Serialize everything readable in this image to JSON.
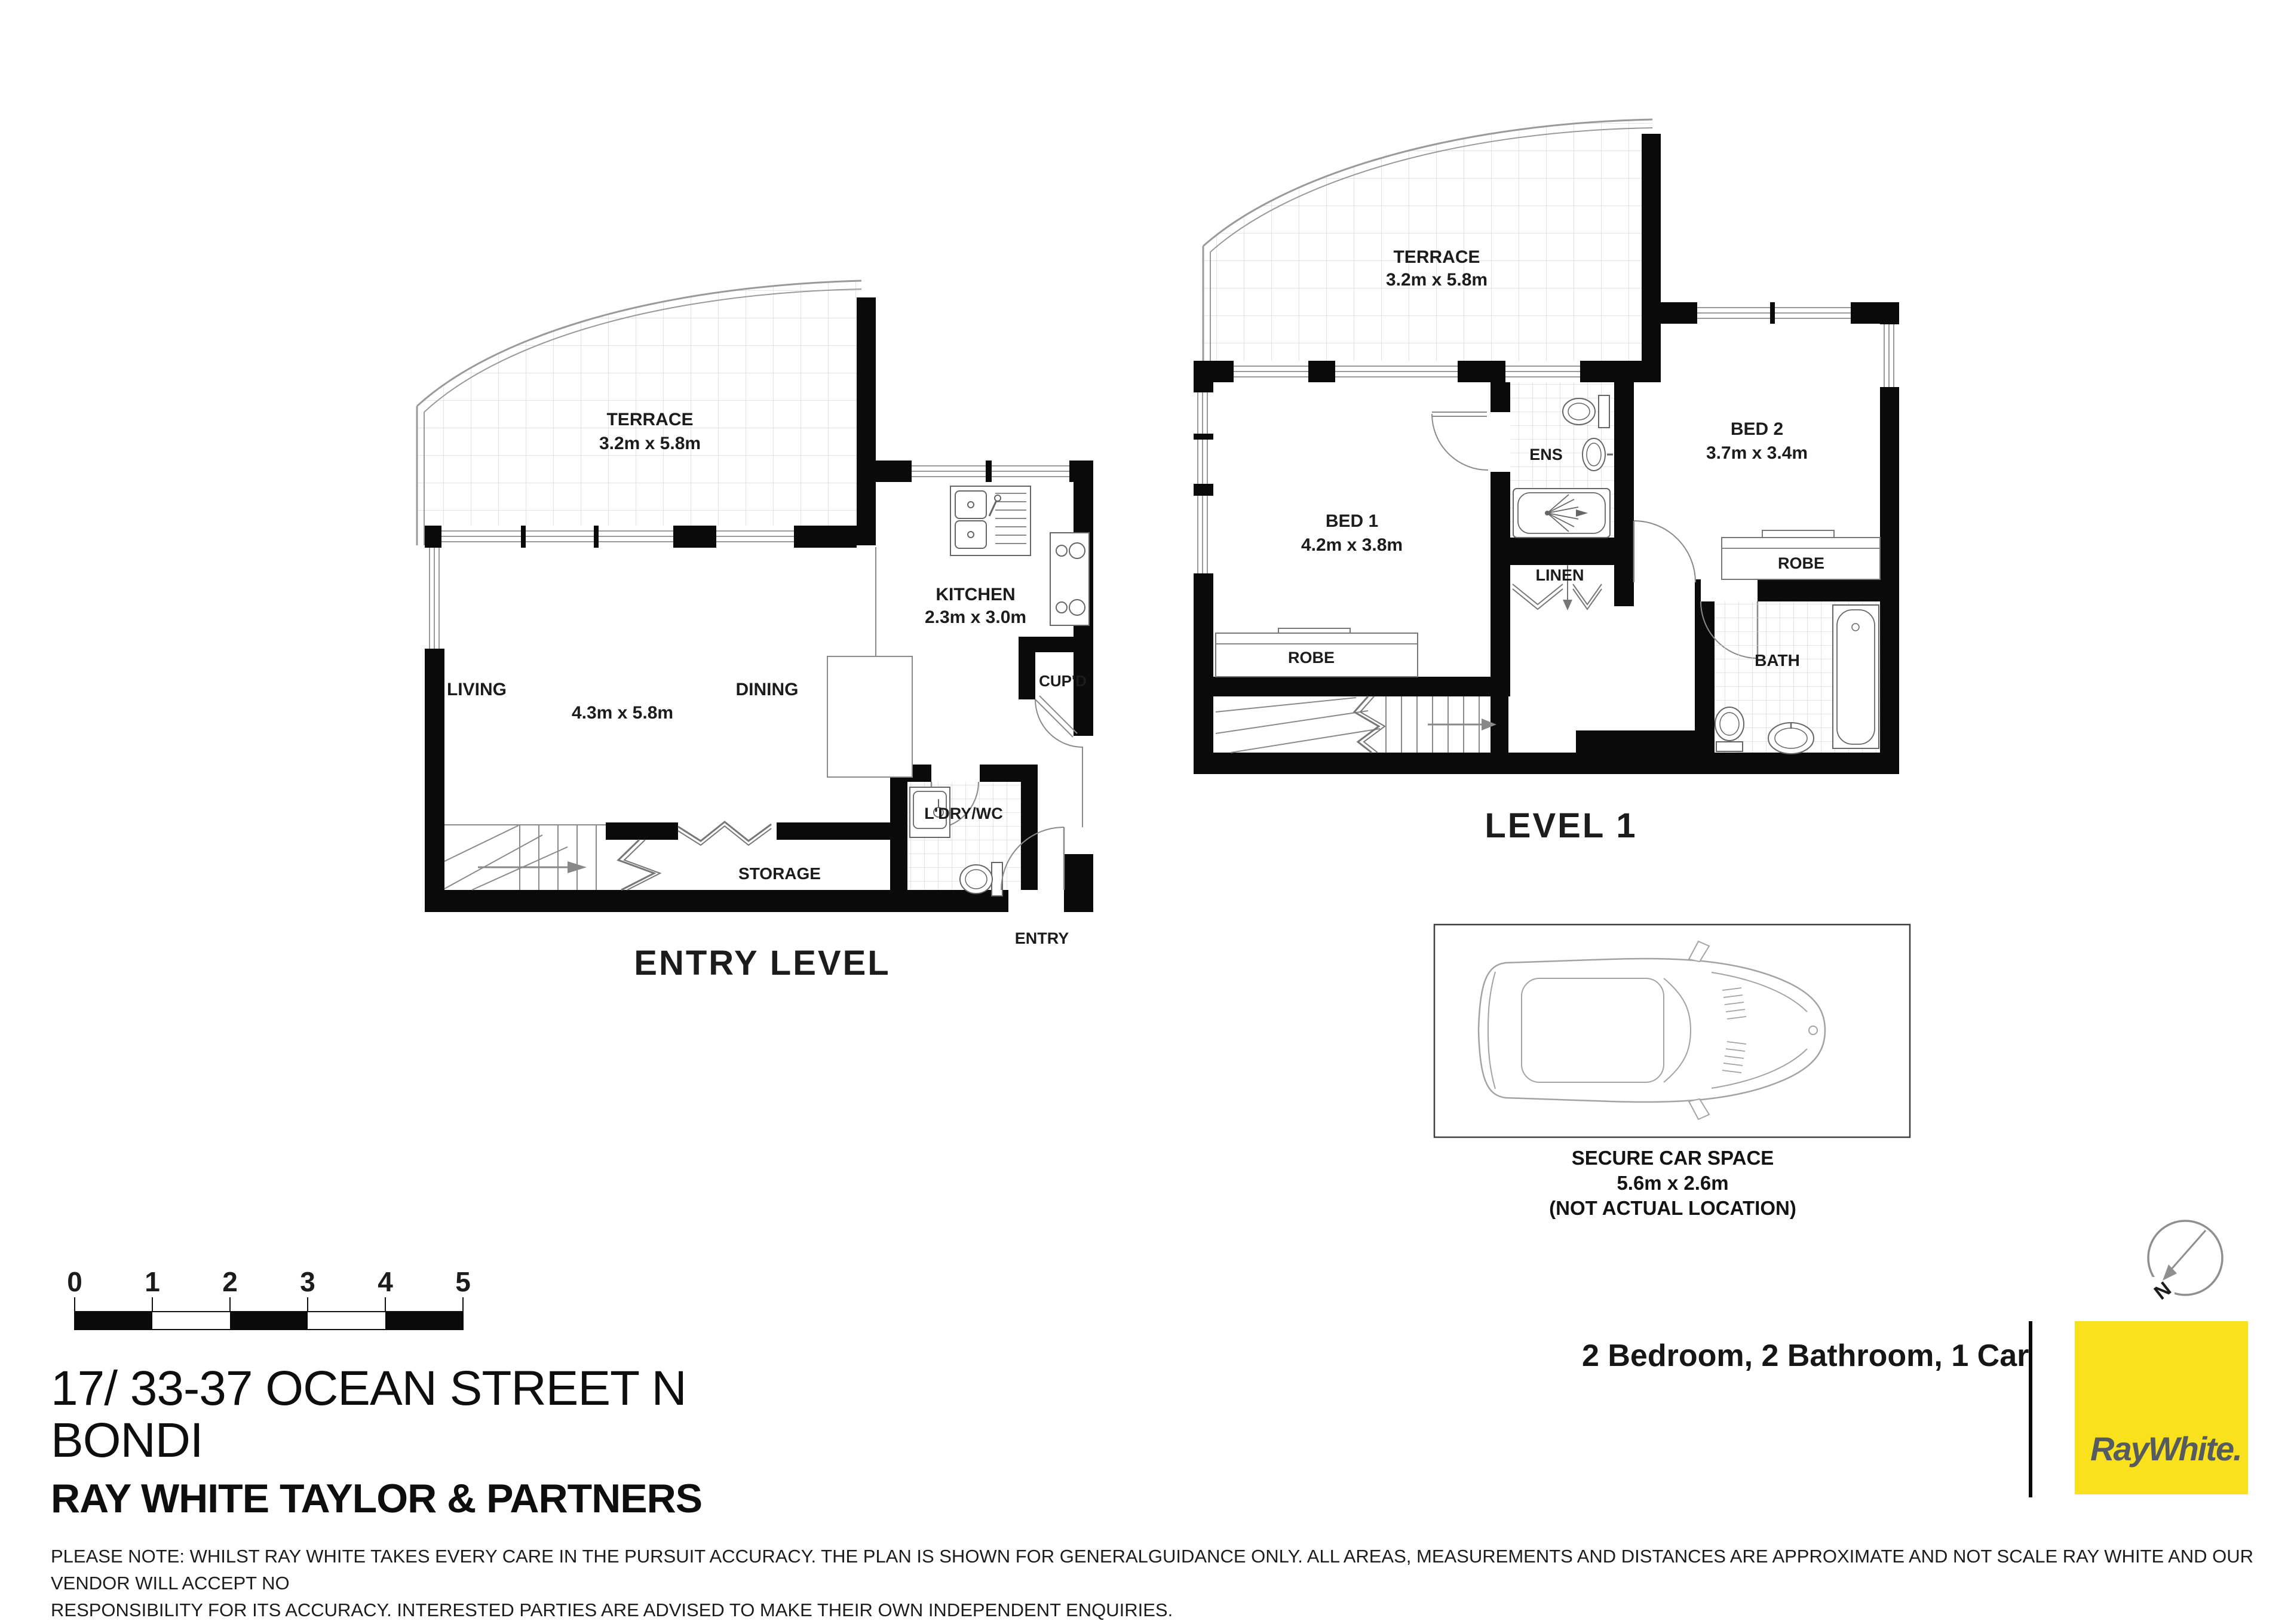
{
  "colors": {
    "wall": "#0a0a0a",
    "thin_line": "#8a8a8a",
    "brand_yellow": "#F9E11E",
    "brand_text": "#565B60"
  },
  "plans": {
    "entry_level": {
      "title": "ENTRY LEVEL",
      "labels": {
        "terrace": "TERRACE",
        "terrace_dims": "3.2m x 5.8m",
        "kitchen": "KITCHEN",
        "kitchen_dims": "2.3m x 3.0m",
        "living": "LIVING",
        "dining": "DINING",
        "living_dining_dims": "4.3m x 5.8m",
        "cupboard": "CUP'D",
        "storage": "STORAGE",
        "laundry_wc": "L'DRY/WC",
        "entry": "ENTRY"
      }
    },
    "level_1": {
      "title": "LEVEL 1",
      "labels": {
        "terrace": "TERRACE",
        "terrace_dims": "3.2m x 5.8m",
        "bed1": "BED 1",
        "bed1_dims": "4.2m x 3.8m",
        "bed2": "BED 2",
        "bed2_dims": "3.7m x 3.4m",
        "ens": "ENS",
        "linen": "LINEN",
        "robe_bed1": "ROBE",
        "robe_bed2": "ROBE",
        "bath": "BATH"
      }
    },
    "car_space": {
      "title": "SECURE CAR SPACE",
      "dims": "5.6m x 2.6m",
      "note": "(NOT ACTUAL LOCATION)"
    }
  },
  "scale_bar": {
    "ticks": [
      "0",
      "1",
      "2",
      "3",
      "4",
      "5"
    ]
  },
  "compass": {
    "north_label": "N"
  },
  "footer": {
    "address_line1": "17/ 33-37 OCEAN STREET N",
    "address_line2": "BONDI",
    "agency": "RAY WHITE TAYLOR & PARTNERS",
    "disclaimer_line1": "PLEASE NOTE: WHILST RAY WHITE TAKES EVERY CARE IN THE PURSUIT ACCURACY. THE PLAN IS SHOWN FOR GENERALGUIDANCE ONLY. ALL AREAS, MEASUREMENTS AND DISTANCES ARE APPROXIMATE AND NOT SCALE RAY WHITE AND OUR VENDOR WILL ACCEPT NO",
    "disclaimer_line2": "RESPONSIBILITY FOR ITS ACCURACY. INTERESTED PARTIES ARE ADVISED TO MAKE THEIR OWN INDEPENDENT ENQUIRIES.",
    "summary": "2 Bedroom, 2 Bathroom, 1 Car",
    "brand_name": "RayWhite."
  }
}
